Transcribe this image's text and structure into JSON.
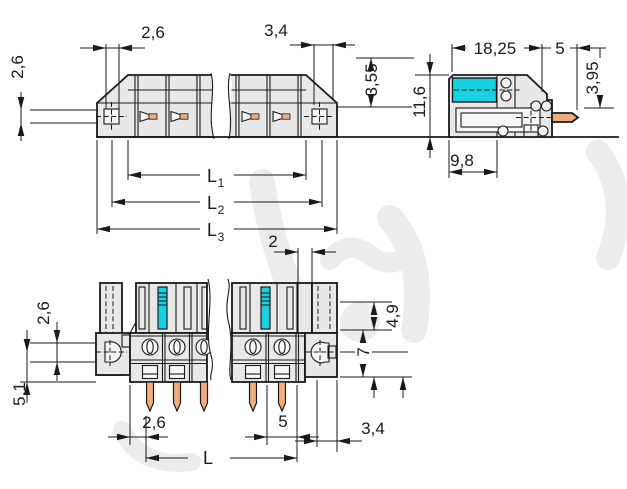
{
  "drawing": {
    "type": "connector-dimensional-drawing",
    "views": {
      "top": {
        "dims": {
          "pitch_small": "2,6",
          "hole_size": "2,6",
          "end_width": "3,4",
          "flange_drop": "3,55",
          "l1": {
            "base": "L",
            "sub": "1"
          },
          "l2": {
            "base": "L",
            "sub": "2"
          },
          "l3": {
            "base": "L",
            "sub": "3"
          }
        }
      },
      "side": {
        "dims": {
          "depth": "18,25",
          "pin_length": "5",
          "pin_offset": "3,95",
          "height": "11,6",
          "clamp_depth": "9,8"
        }
      },
      "front": {
        "dims": {
          "slot_width": "2",
          "hole_size": "2,6",
          "hole_to_base": "5,1",
          "upper_depth": "4,9",
          "lower_height": "7",
          "edge_offset": "2,6",
          "pitch": "5",
          "end_width": "3,4",
          "total_length": "L"
        }
      }
    },
    "colors": {
      "line": "#1a1a1a",
      "body_fill": "#e8e8e8",
      "hole_fill": "#f6f6f6",
      "accent_cyan": "#18d2e2",
      "pin_orange": "#f4ab7a",
      "watermark": "#ececec"
    }
  }
}
